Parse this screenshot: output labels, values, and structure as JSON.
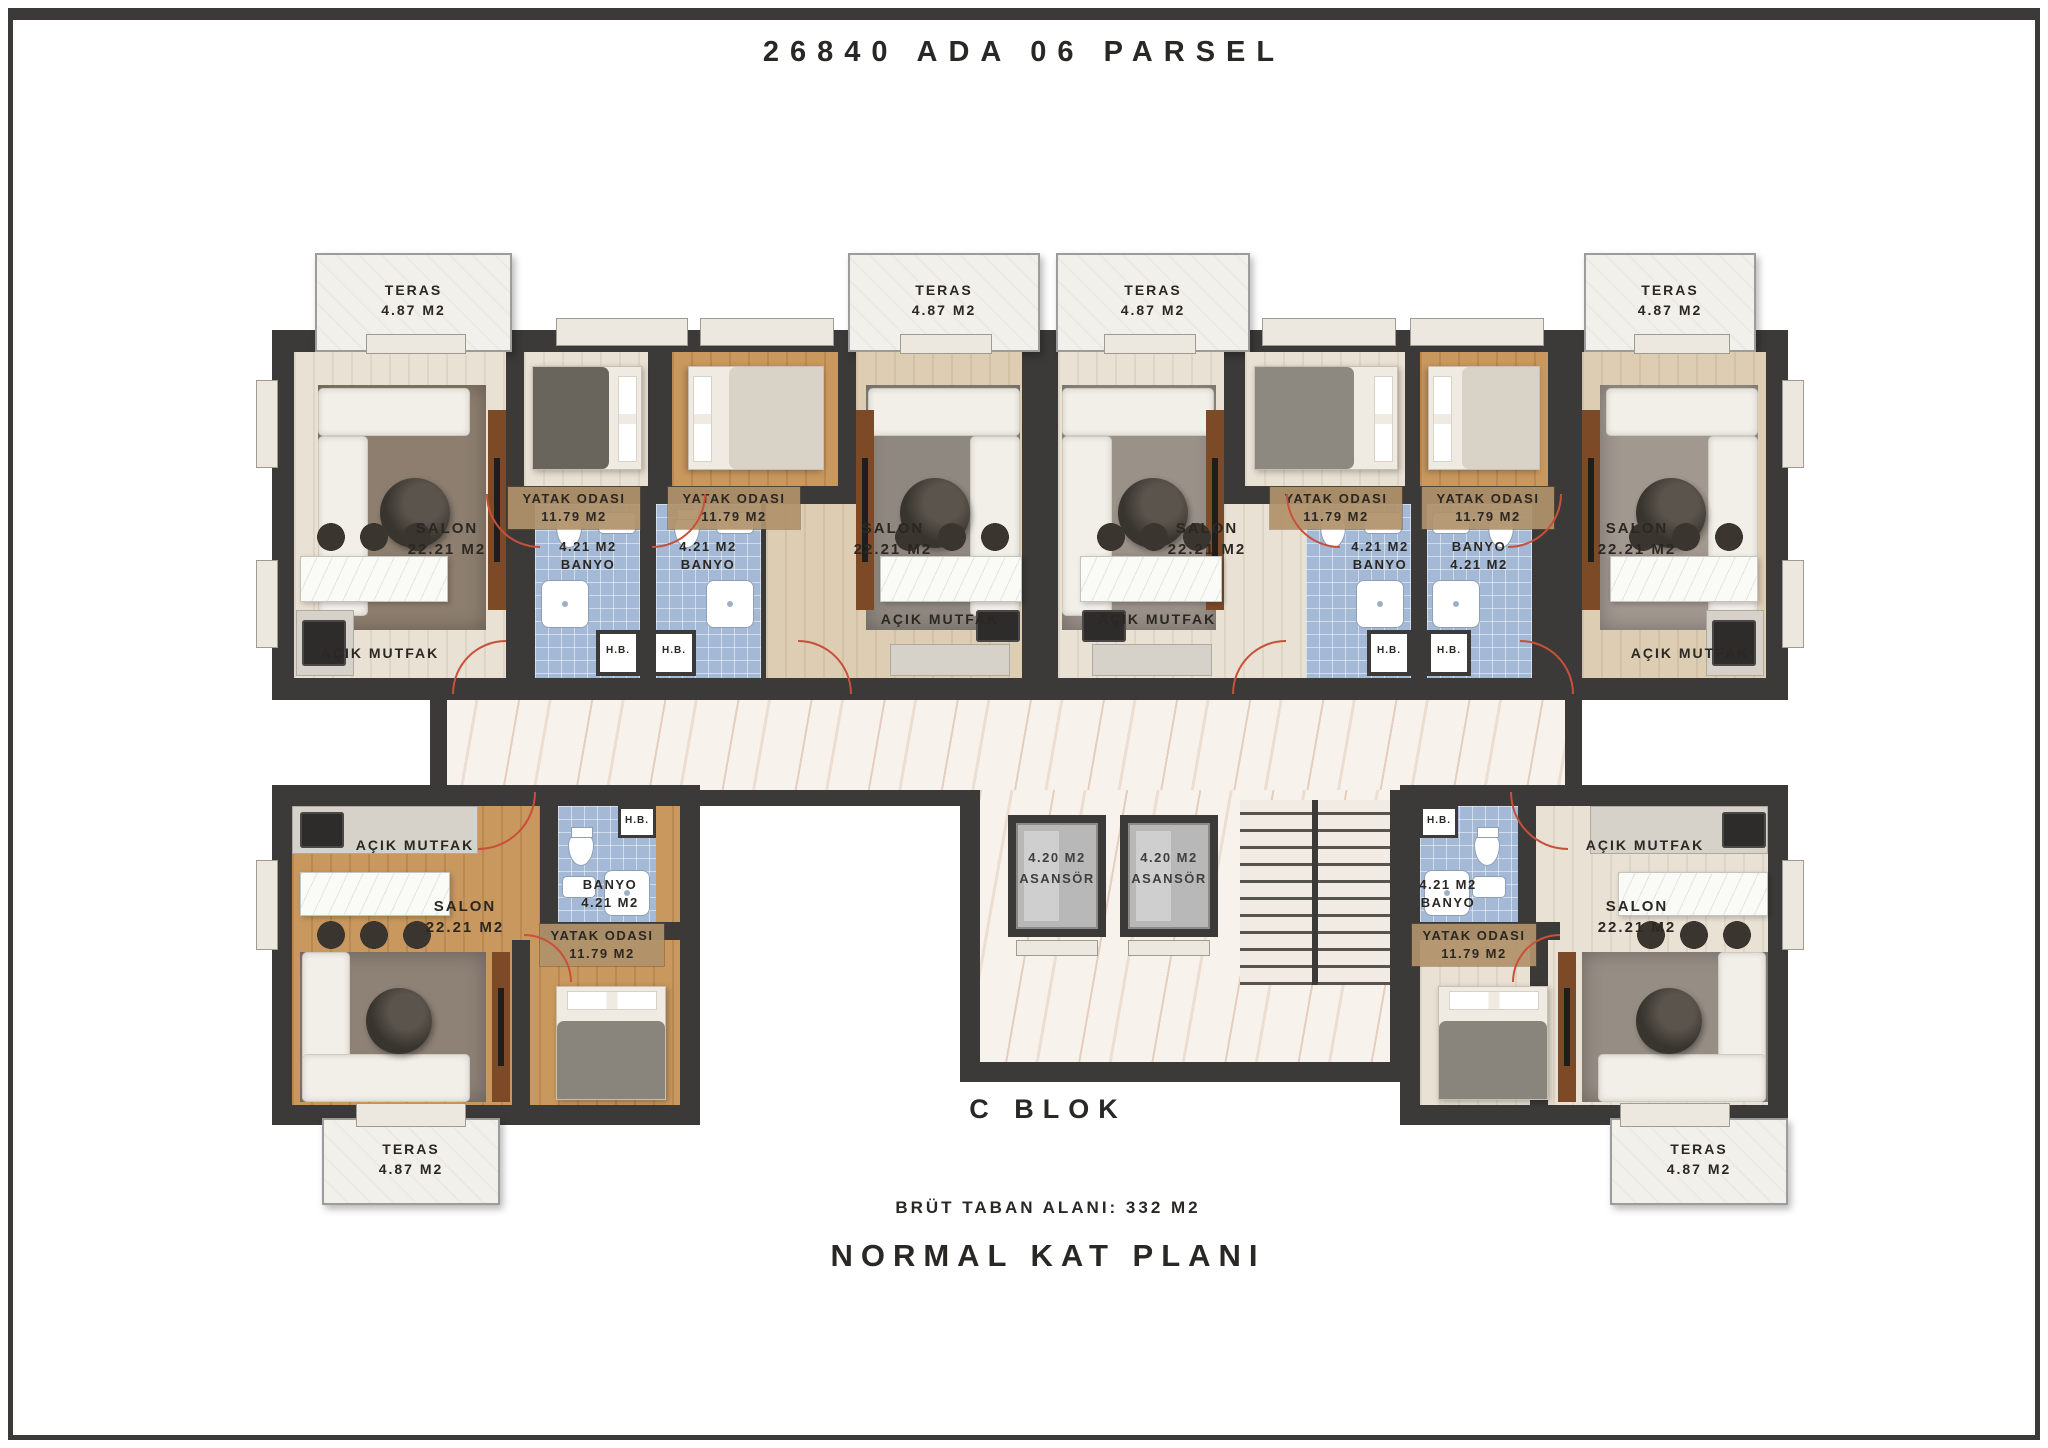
{
  "page_title": "26840 ADA 06 PARSEL",
  "block": {
    "name": "C BLOK",
    "gross_floor_area": "BRÜT TABAN ALANI: 332 M2",
    "plan_type": "NORMAL KAT PLANI"
  },
  "rooms": {
    "teras": {
      "label": "TERAS",
      "area": "4.87 M2"
    },
    "salon": {
      "label": "SALON",
      "area": "22.21 M2"
    },
    "yatak_odasi": {
      "label": "YATAK ODASI",
      "area": "11.79 M2"
    },
    "banyo": {
      "label": "BANYO",
      "area": "4.21 M2"
    },
    "acik_mutfak": {
      "label": "AÇIK MUTFAK"
    },
    "hb": {
      "label": "H.B."
    },
    "asansor": {
      "label": "ASANSÖR",
      "area": "4.20 M2"
    }
  },
  "colors": {
    "wall": "#3c3a38",
    "bath_tile": "#a3b9d6",
    "oak_floor": "#c9985e",
    "pale_floor": "#e9e1d3",
    "corridor_vein": "#bb845c",
    "door_swing": "#c8503a",
    "label_text": "#2b2722"
  }
}
